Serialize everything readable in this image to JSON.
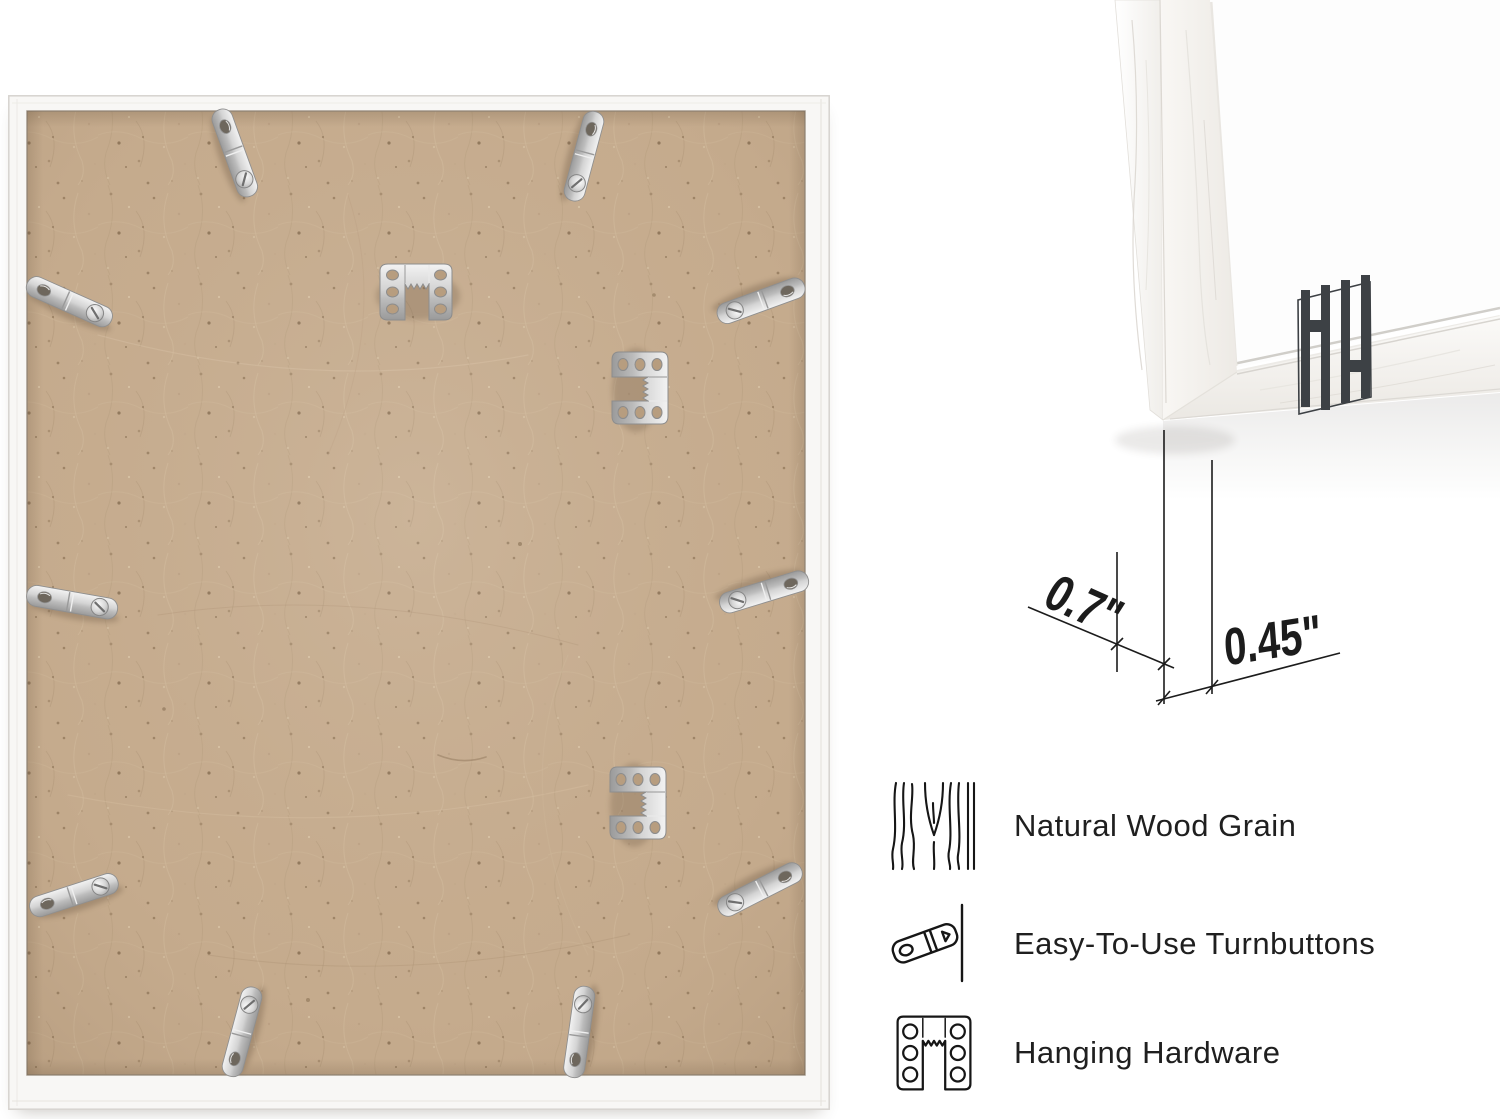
{
  "features": {
    "items": [
      {
        "icon": "wood-grain-icon",
        "label": "Natural Wood Grain"
      },
      {
        "icon": "turnbutton-icon",
        "label": "Easy-To-Use Turnbuttons"
      },
      {
        "icon": "hanging-hardware-icon",
        "label": "Hanging Hardware"
      }
    ]
  },
  "dimensions": {
    "depth": "0.7\"",
    "face_width": "0.45\""
  },
  "logo": {
    "icon": "hh-monogram-logo",
    "color": "#3d4145"
  },
  "colors": {
    "page_background": "#ffffff",
    "mdf_board": "#c6ac8e",
    "frame_white": "#f8f7f5",
    "metal_hardware": "#c9c9c9",
    "annotation_ink": "#1c1c1c",
    "feature_text": "#1f1f1f"
  }
}
